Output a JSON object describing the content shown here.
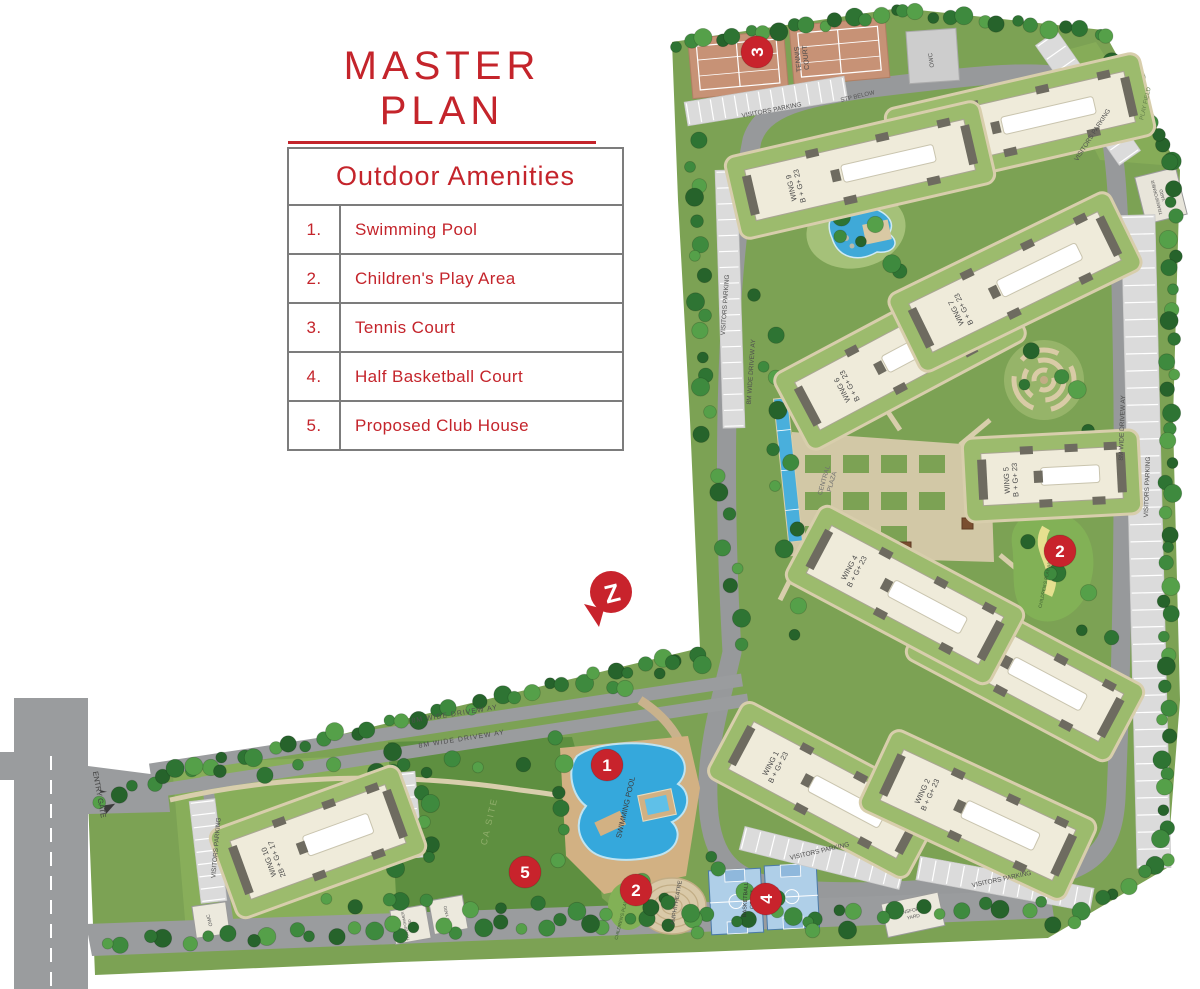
{
  "title": "MASTER PLAN",
  "amenities": {
    "heading": "Outdoor Amenities",
    "items": [
      {
        "num": "1.",
        "label": "Swimming Pool"
      },
      {
        "num": "2.",
        "label": "Children's Play Area"
      },
      {
        "num": "3.",
        "label": "Tennis Court"
      },
      {
        "num": "4.",
        "label": "Half Basketball Court"
      },
      {
        "num": "5.",
        "label": "Proposed Club House"
      }
    ]
  },
  "map": {
    "wings": [
      {
        "name": "WING 1",
        "floors": "B + G+ 23"
      },
      {
        "name": "WING 2",
        "floors": "B + G+ 23"
      },
      {
        "name": "WING 3",
        "floors": "B + G+ 23"
      },
      {
        "name": "WING 4",
        "floors": "B + G+ 23"
      },
      {
        "name": "WING 5",
        "floors": "B + G+ 23"
      },
      {
        "name": "WING 6",
        "floors": "B + G+ 23"
      },
      {
        "name": "WING 7",
        "floors": "B + G+ 23"
      },
      {
        "name": "WING 8",
        "floors": "B + G+ 23"
      },
      {
        "name": "WING 9",
        "floors": "B + G+ 23"
      },
      {
        "name": "WING 10",
        "floors": "2B + G+ 17"
      }
    ],
    "markers": [
      {
        "num": "1"
      },
      {
        "num": "2"
      },
      {
        "num": "2"
      },
      {
        "num": "3"
      },
      {
        "num": "4"
      },
      {
        "num": "5"
      }
    ],
    "labels": {
      "tennis_l1": "TENNIS",
      "tennis_l2": "COURT",
      "swimming_pool": "SWIMMING POOL",
      "basketball_l1": "BASKETBALL",
      "basketball_l2": "COURT",
      "amphitheatre": "AMPHITHEATRE",
      "central_l1": "CENTRAL",
      "central_l2": "PLAZA",
      "childrens_play_area": "CHILDREN'S PLAY AREA",
      "play_field": "PLAY FIELD",
      "ca_site": "CA SITE",
      "visitors_parking": "VISITORS PARKING",
      "driveway": "8M WIDE DRIVEW AY",
      "entry_gate": "ENTRY GATE",
      "stp_below": "STP BELOW",
      "transformer_l1": "TRANSFORMER",
      "transformer_l2": "YARD",
      "dg_yard": "DG YARD",
      "owc": "OWC",
      "logo_letter": "Z"
    }
  },
  "colors": {
    "accent_red": "#C4242B",
    "marker_red": "#C8232C",
    "site_green": "#7CA254",
    "lawn_dark": "#5E8F40",
    "road_gray": "#97999B",
    "building_cream": "#EFEBDA",
    "pool_blue": "#35A8DC",
    "court_tan": "#C79276",
    "basket_blue": "#AFCFE8"
  }
}
